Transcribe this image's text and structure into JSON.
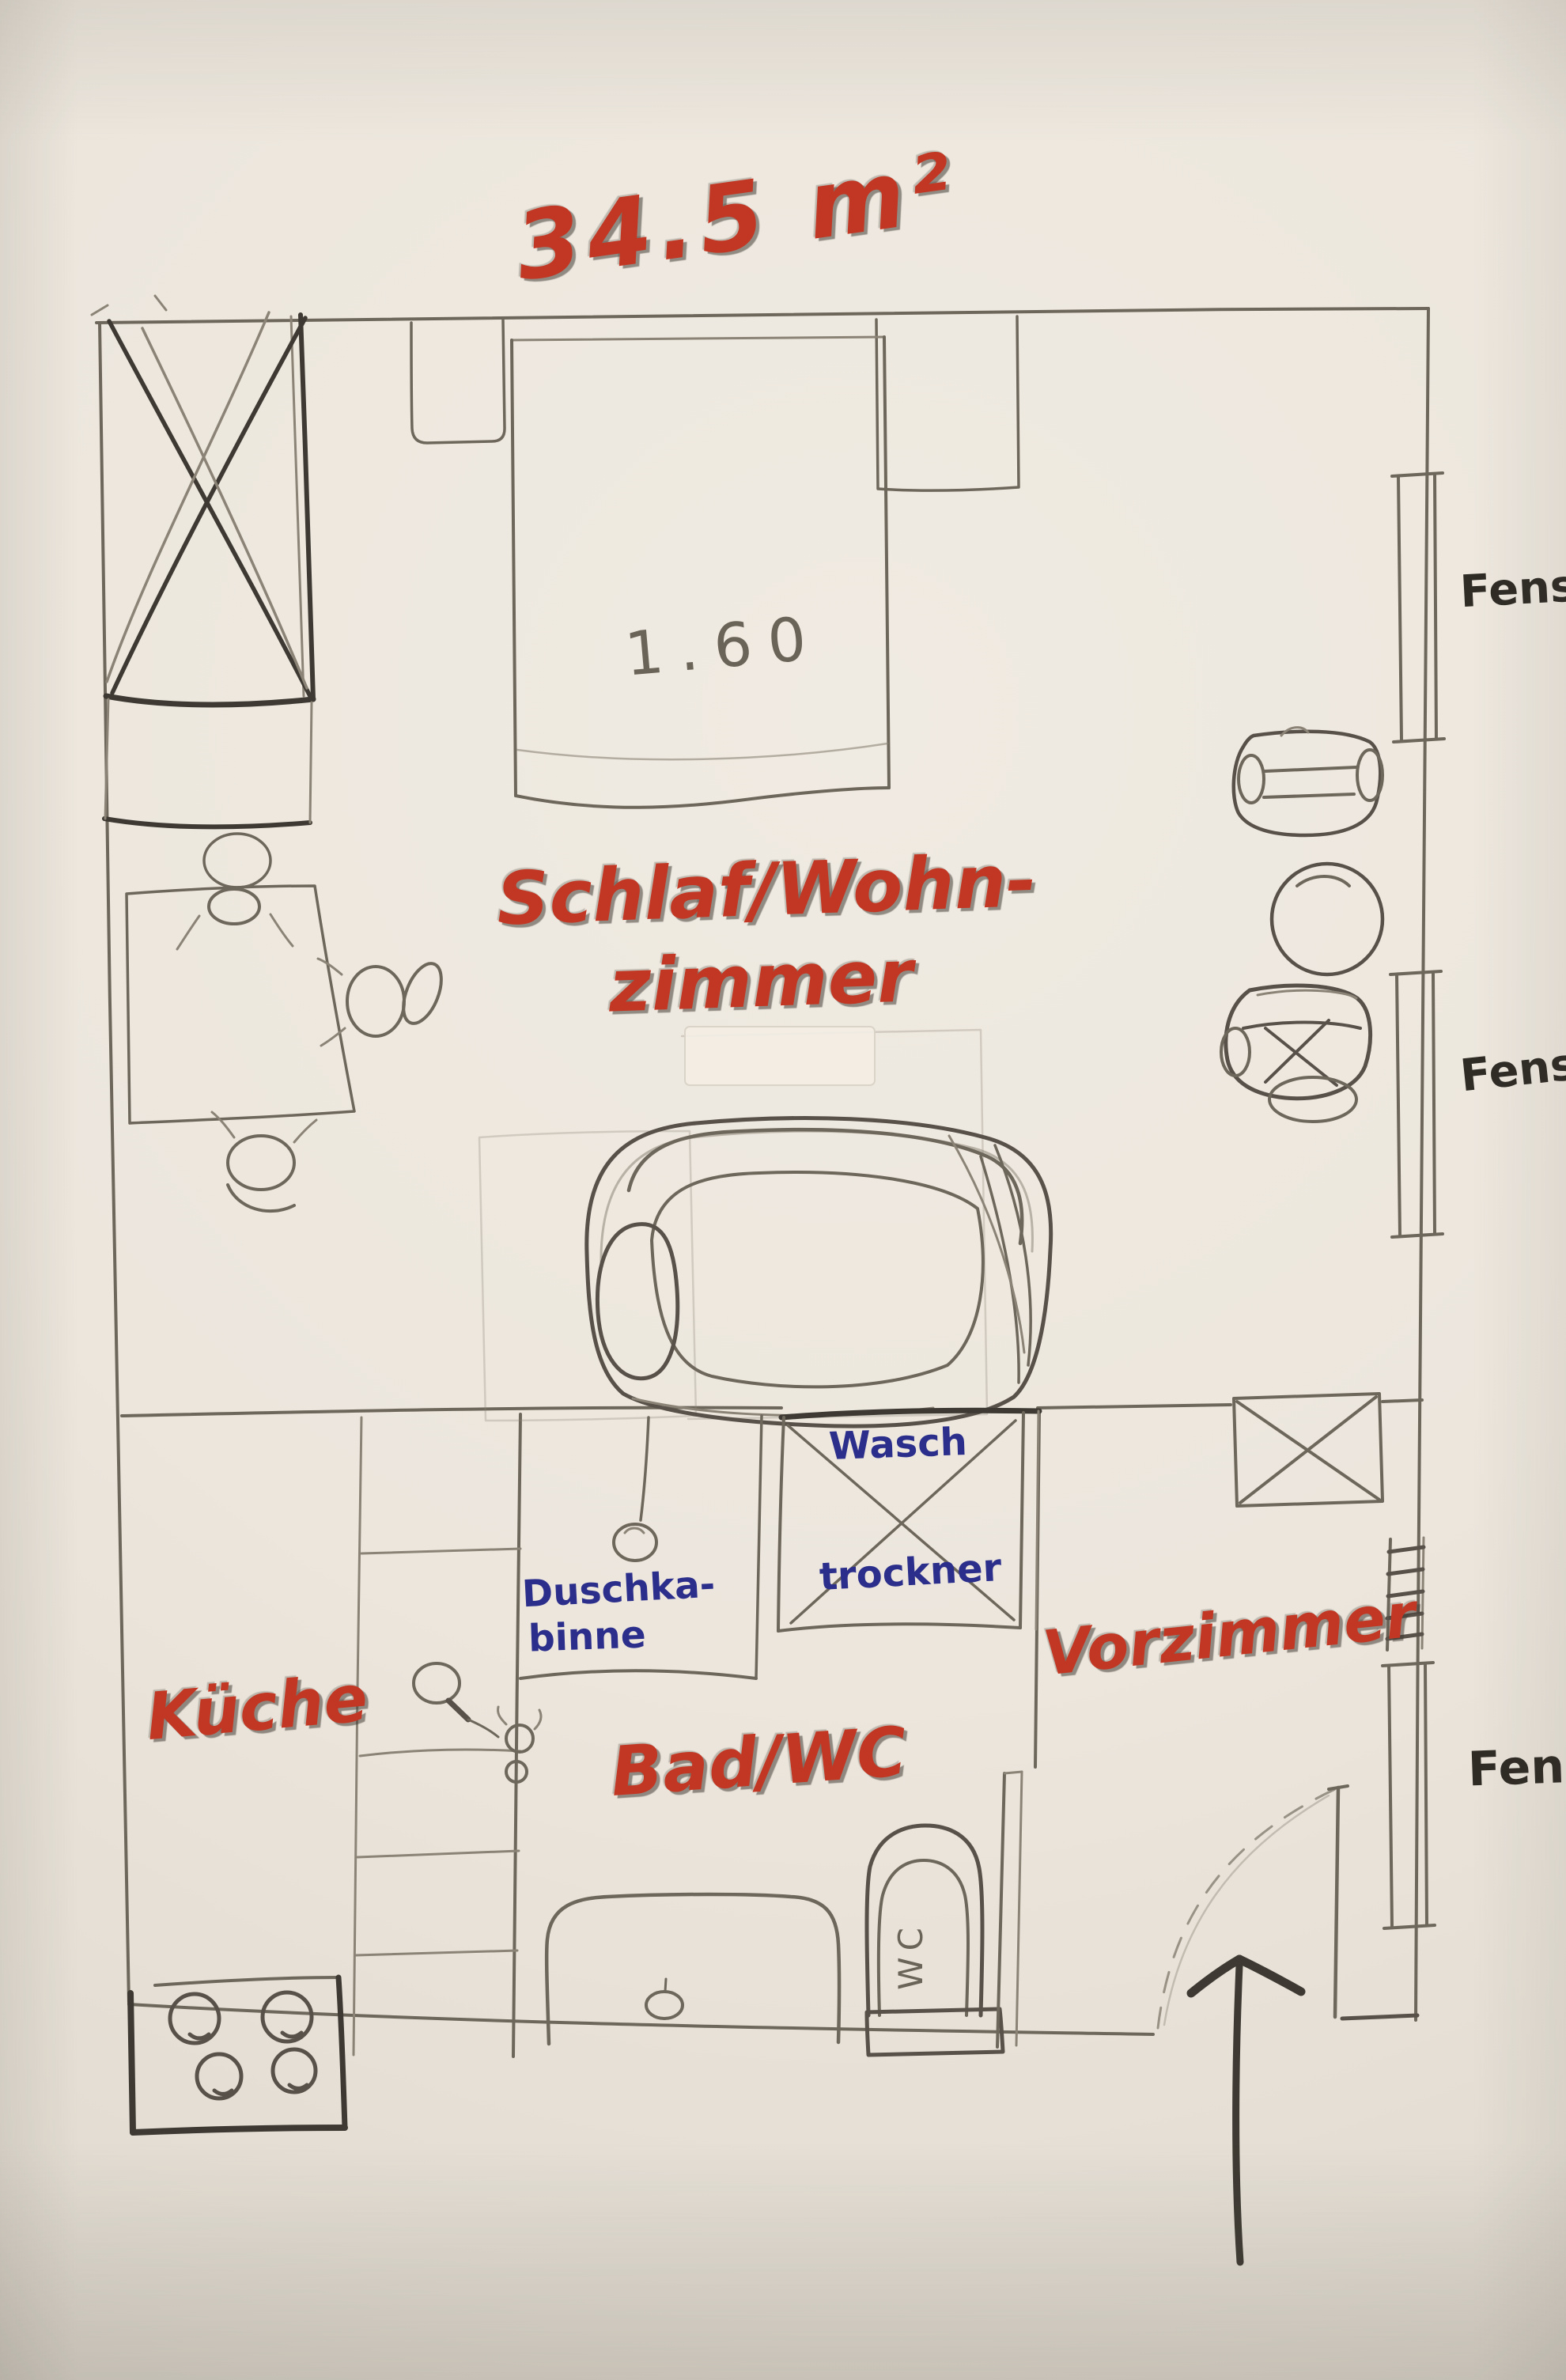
{
  "title": {
    "text": "34.5 m²"
  },
  "rooms": {
    "living": {
      "label_line1": "Schlaf/Wohn-",
      "label_line2": "zimmer"
    },
    "kitchen": {
      "label": "Küche"
    },
    "bath": {
      "label": "Bad/WC"
    },
    "hall": {
      "label": "Vorzimmer"
    }
  },
  "furniture": {
    "bed": {
      "width_label": "1.60"
    },
    "shower": {
      "label_line1": "Duschka-",
      "label_line2": "binne"
    },
    "washer_dryer": {
      "label_line1": "Wasch",
      "label_line2": "trockner"
    },
    "toilet": {
      "label": "WC"
    }
  },
  "windows": {
    "labels": [
      "Fenster",
      "Fenster",
      "Fenster"
    ]
  },
  "colors": {
    "red_marker": "#c13723",
    "blue_ink": "#2b2e8a",
    "pencil": "#6a6458",
    "dark_pen": "#2f2b25",
    "paper": "#ece6dd"
  }
}
